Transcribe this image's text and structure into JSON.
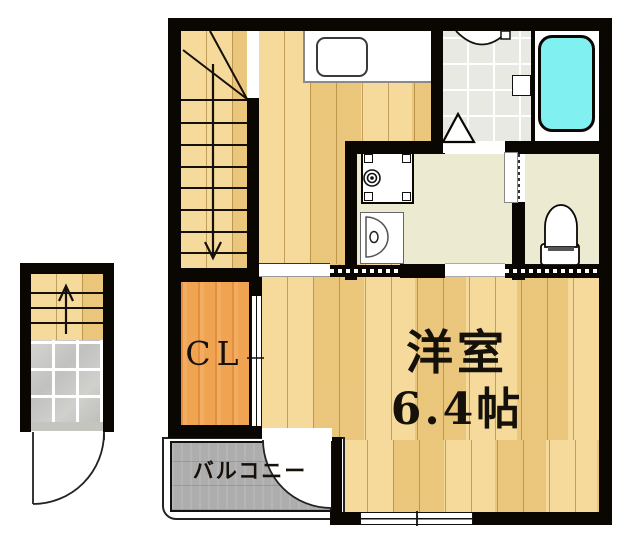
{
  "plan_type": "apartment-floor-plan",
  "labels": {
    "closet": "CL",
    "main_room_name": "洋室",
    "main_room_size": "6.4帖",
    "balcony": "バルコニー"
  },
  "fixtures": [
    "staircase-down-arrow",
    "entrance-staircase-up-arrow",
    "kitchen-counter",
    "kitchen-sink",
    "bathtub",
    "shower-room-grid-floor",
    "shower-door-triangle",
    "washing-machine-pan",
    "washbasin",
    "toilet",
    "closet-sliding-door",
    "toilet-door",
    "balcony-swing-door",
    "entrance-swing-door",
    "sliding-window",
    "balcony-parapet"
  ],
  "colors": {
    "background": "#ffffff",
    "wall": "#0a0703",
    "wood_floor": "#f1cf85",
    "closet_floor": "#f0a351",
    "washroom_floor": "#ecead1",
    "shower_floor": "#e9e9e4",
    "bathtub_fill": "#80f0f0",
    "balcony_floor": "#adadad",
    "tile_floor": "#c8c8c6",
    "line": "#15100a"
  }
}
